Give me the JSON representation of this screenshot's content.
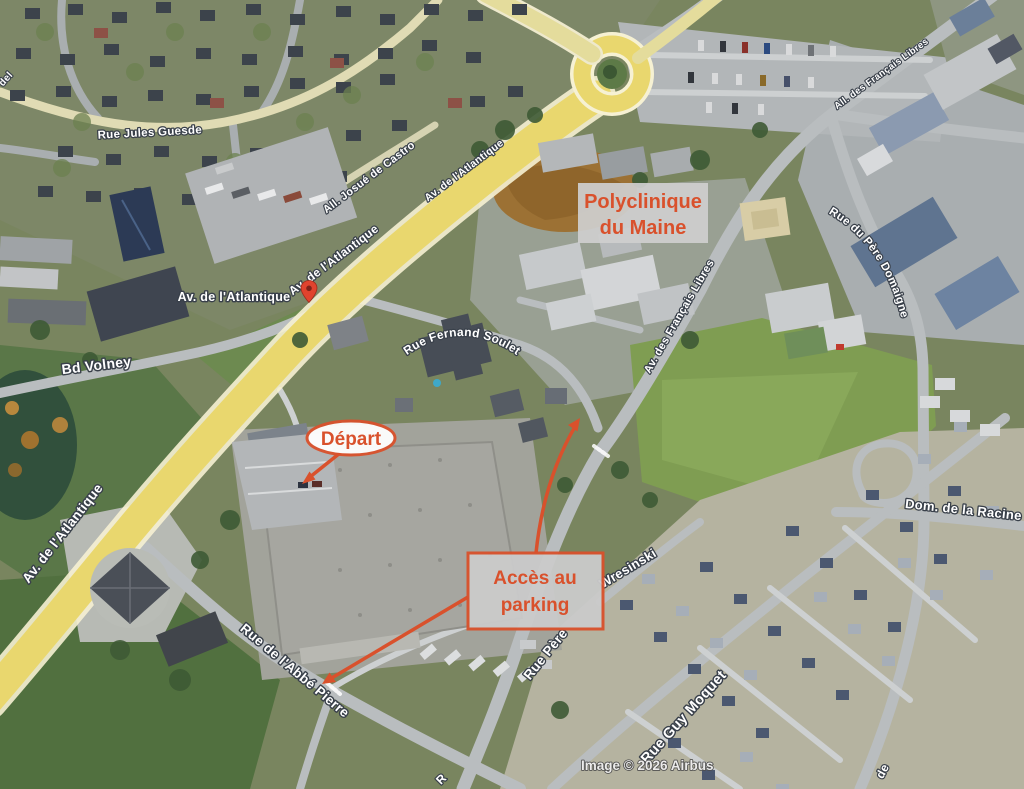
{
  "map": {
    "attribution": "Image © 2026 Airbus",
    "colors": {
      "annotation_red": "#d9512c",
      "road_yellow": "#e9d76e",
      "minor_road_yellow": "#e0dbb4",
      "label_fill": "#ffffff",
      "label_outline": "#39404a",
      "annotation_box_bg": "#cbcbcb",
      "depart_oval_bg": "#ffffff",
      "pin_red": "#e0432e"
    },
    "street_labels": [
      {
        "name": "rue-jules-guesde",
        "text": "Rue Jules Guesde"
      },
      {
        "name": "all-josue-de-castro",
        "text": "All. Josué de Castro"
      },
      {
        "name": "av-de-l-atlantique-ne",
        "text": "Av. de l'Atlantique"
      },
      {
        "name": "av-de-l-atlantique-mid",
        "text": "Av. de l'Atlantique"
      },
      {
        "name": "av-de-l-atlantique-main",
        "text": "Av. de l'Atlantique"
      },
      {
        "name": "bd-volney",
        "text": "Bd Volney"
      },
      {
        "name": "av-de-l-atlantique-sw",
        "text": "Av. de l'Atlantique"
      },
      {
        "name": "rue-fernand-soulet",
        "text": "Rue Fernand Soulet"
      },
      {
        "name": "av-des-francais-libres",
        "text": "Av. des Français Libres"
      },
      {
        "name": "all-des-francais-libres",
        "text": "All. des Français Libres"
      },
      {
        "name": "rue-du-pere-domaigne",
        "text": "Rue du Père Domaigne"
      },
      {
        "name": "wresinski",
        "text": "Wresinski"
      },
      {
        "name": "rue-pere",
        "text": "Rue Père"
      },
      {
        "name": "rue-guy-moquet",
        "text": "Rue Guy Moquet"
      },
      {
        "name": "rue-de-l-abbe-pierre",
        "text": "Rue de l'Abbé Pierre"
      },
      {
        "name": "dom-de-la-racine",
        "text": "Dom. de la Racine"
      },
      {
        "name": "street-fragment-de",
        "text": "de"
      },
      {
        "name": "street-fragment-del",
        "text": "del"
      },
      {
        "name": "street-fragment-r",
        "text": "R"
      }
    ],
    "annotations": {
      "polyclinique": {
        "line1": "Polyclinique",
        "line2": "du Maine"
      },
      "depart": {
        "text": "Départ"
      },
      "acces_parking": {
        "line1": "Accès au",
        "line2": "parking"
      }
    }
  }
}
